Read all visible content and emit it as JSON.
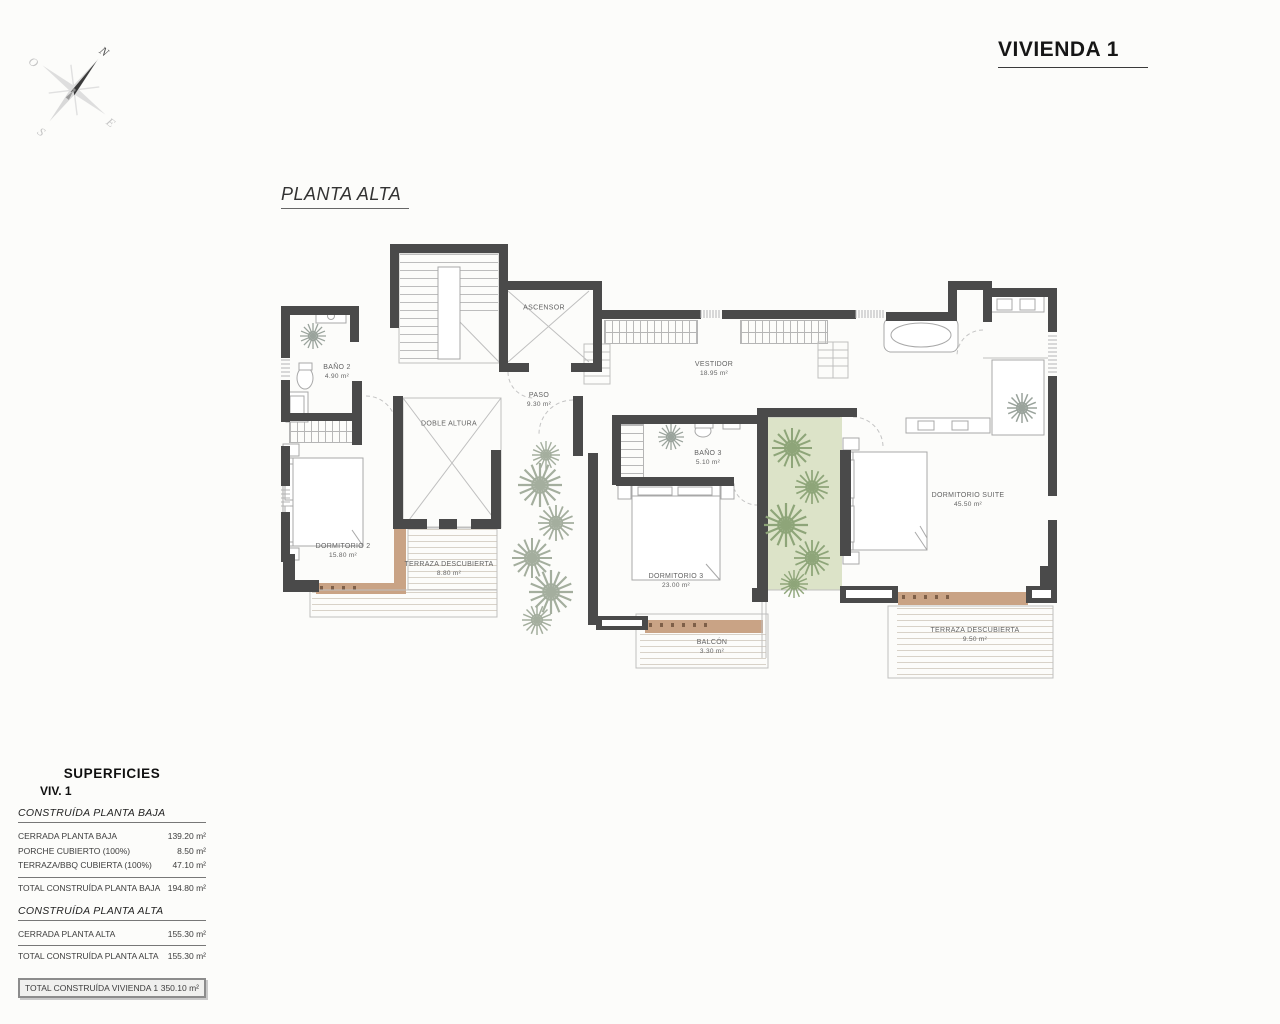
{
  "title": "VIVIENDA 1",
  "plan_label": "PLANTA ALTA",
  "compass": {
    "n": "N",
    "s": "S",
    "e": "E",
    "o": "O"
  },
  "rooms": [
    {
      "name": "ASCENSOR",
      "area": ""
    },
    {
      "name": "BAÑO 2",
      "area": "4.90 m²"
    },
    {
      "name": "PASO",
      "area": "9.30 m²"
    },
    {
      "name": "VESTIDOR",
      "area": "18.95 m²"
    },
    {
      "name": "DOBLE ALTURA",
      "area": ""
    },
    {
      "name": "DORMITORIO 2",
      "area": "15.80 m²"
    },
    {
      "name": "TERRAZA DESCUBIERTA",
      "area": "8.80 m²"
    },
    {
      "name": "BAÑO 3",
      "area": "5.10 m²"
    },
    {
      "name": "DORMITORIO 3",
      "area": "23.00 m²"
    },
    {
      "name": "BALCÓN",
      "area": "3.30 m²"
    },
    {
      "name": "DORMITORIO SUITE",
      "area": "45.50 m²"
    },
    {
      "name": "TERRAZA DESCUBIERTA",
      "area": "9.50 m²"
    }
  ],
  "summary": {
    "heading": "SUPERFICIES",
    "subheading": "VIV. 1",
    "sections": [
      {
        "title": "CONSTRUÍDA PLANTA BAJA",
        "rows": [
          {
            "label": "CERRADA PLANTA BAJA",
            "value": "139.20 m²"
          },
          {
            "label": "PORCHE CUBIERTO (100%)",
            "value": "8.50 m²"
          },
          {
            "label": "TERRAZA/BBQ CUBIERTA (100%)",
            "value": "47.10 m²"
          }
        ],
        "total": {
          "label": "TOTAL CONSTRUÍDA PLANTA BAJA",
          "value": "194.80 m²"
        }
      },
      {
        "title": "CONSTRUÍDA PLANTA ALTA",
        "rows": [
          {
            "label": "CERRADA PLANTA ALTA",
            "value": "155.30 m²"
          }
        ],
        "total": {
          "label": "TOTAL CONSTRUÍDA PLANTA ALTA",
          "value": "155.30 m²"
        }
      }
    ],
    "grand_total": {
      "label": "TOTAL CONSTRUÍDA VIVIENDA 1",
      "value": "350.10 m²"
    }
  },
  "colors": {
    "wall": "#4a4a4a",
    "deck_line": "#d8d2c8",
    "tan_band": "#c9a385",
    "green_patio": "#dce3c8",
    "plant_green": "#8ea579",
    "plant_gray": "#a4ae9e"
  }
}
